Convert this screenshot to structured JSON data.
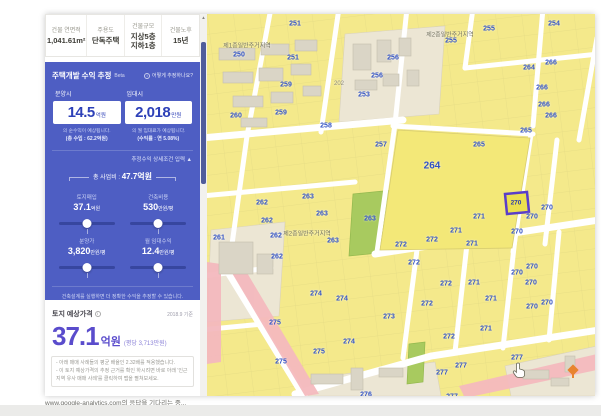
{
  "info_bar": {
    "columns": [
      {
        "label": "건물 연면적",
        "value": "1,041.61m²"
      },
      {
        "label": "주용도",
        "value": "단독주택"
      },
      {
        "label": "건물규모",
        "value": "지상5층\n지하1층"
      },
      {
        "label": "건물노후",
        "value": "15년"
      }
    ]
  },
  "profit_panel": {
    "title": "주택개발 수익 추정",
    "beta": "Beta",
    "how_link": "어떻게 추정하나요?",
    "sale_label": "분양시",
    "sale_value": "14.5",
    "sale_unit": "억원",
    "sale_caption": "의 순수익이 예상됩니다.",
    "sale_sub": "(총 수입 : 62.2억원)",
    "rent_label": "임대시",
    "rent_value": "2,018",
    "rent_unit": "만원",
    "rent_caption": "의 월 임대료가 예상됩니다.",
    "rent_sub": "(수익률 : 연 5.08%)",
    "detail_toggle": "추정수익 상세조건 입력",
    "total_label": "총 사업비 :",
    "total_value": "47.7억원",
    "sliders": [
      {
        "label": "토지매입",
        "value": "37.1",
        "unit": "억원"
      },
      {
        "label": "건축비용",
        "value": "530",
        "unit": "만원/평"
      },
      {
        "label": "분양가",
        "value": "3,820",
        "unit": "만원/평"
      },
      {
        "label": "월 임대수익",
        "value": "12.4",
        "unit": "만원/평"
      }
    ],
    "design_hint": "건축설계를 실행하면 더 정확한 수익을 추정할 수 있습니다.",
    "design_button": "인공지능 건축설계 실행"
  },
  "land_price": {
    "title": "토지 예상가격",
    "as_of": "2018.9 기준",
    "value": "37.1",
    "unit": "억원",
    "per_pyeong": "(평당 3,713만원)",
    "notes": [
      "- 아래 매매 사례들의 평균 배율인 2.32배를 적용했습니다.",
      "- 이 토지 예상가격의 추정 근거를 확인 하시려면 바로 아래 '인근 지역 유사 매매 사례'를 클릭하여 맵을 펼쳐보세요."
    ]
  },
  "status_bar": {
    "text": "www.google-analytics.com의 응답을 기다리는 중..."
  },
  "icons": {
    "info": "i",
    "help": "i",
    "up_arrow": "▲",
    "scroll_up": "▲"
  },
  "map": {
    "colors": {
      "parcel_yellow": "#f4e98b",
      "road_white": "#ffffff",
      "label_blue": "#3353c4",
      "green_parcel": "#a8ca5f",
      "pink_zone": "#f4b9be",
      "building_gray": "#dad5c6",
      "selected_outline": "#5a3ec9"
    },
    "selected_parcel": {
      "label": "270"
    },
    "zone_labels": [
      {
        "t": "제1종일반주거지역",
        "x": 40,
        "y": 31
      },
      {
        "t": "제2종일반주거지역",
        "x": 243,
        "y": 20
      },
      {
        "t": "제2종일반주거지역",
        "x": 100,
        "y": 219
      }
    ],
    "parcel_labels": [
      {
        "t": "250",
        "x": 32,
        "y": 41
      },
      {
        "t": "251",
        "x": 88,
        "y": 10
      },
      {
        "t": "251",
        "x": 86,
        "y": 44
      },
      {
        "t": "259",
        "x": 79,
        "y": 71
      },
      {
        "t": "259",
        "x": 74,
        "y": 99
      },
      {
        "t": "260",
        "x": 29,
        "y": 102
      },
      {
        "t": "261",
        "x": 12,
        "y": 224
      },
      {
        "t": "262",
        "x": 55,
        "y": 189
      },
      {
        "t": "262",
        "x": 60,
        "y": 207
      },
      {
        "t": "262",
        "x": 69,
        "y": 222
      },
      {
        "t": "262",
        "x": 70,
        "y": 243
      },
      {
        "t": "263",
        "x": 101,
        "y": 183
      },
      {
        "t": "263",
        "x": 115,
        "y": 200
      },
      {
        "t": "263",
        "x": 126,
        "y": 227
      },
      {
        "t": "263",
        "x": 163,
        "y": 205
      },
      {
        "t": "264",
        "x": 225,
        "y": 152,
        "big": true
      },
      {
        "t": "264",
        "x": 322,
        "y": 54
      },
      {
        "t": "265",
        "x": 272,
        "y": 131
      },
      {
        "t": "265",
        "x": 319,
        "y": 117
      },
      {
        "t": "266",
        "x": 344,
        "y": 49
      },
      {
        "t": "266",
        "x": 335,
        "y": 74
      },
      {
        "t": "266",
        "x": 337,
        "y": 91
      },
      {
        "t": "266",
        "x": 344,
        "y": 102
      },
      {
        "t": "253",
        "x": 157,
        "y": 81
      },
      {
        "t": "254",
        "x": 347,
        "y": 10
      },
      {
        "t": "255",
        "x": 282,
        "y": 15
      },
      {
        "t": "255",
        "x": 244,
        "y": 27
      },
      {
        "t": "256",
        "x": 186,
        "y": 44
      },
      {
        "t": "256",
        "x": 170,
        "y": 62
      },
      {
        "t": "257",
        "x": 174,
        "y": 131
      },
      {
        "t": "258",
        "x": 119,
        "y": 112
      },
      {
        "t": "202",
        "x": 132,
        "y": 70,
        "gray": true
      },
      {
        "t": "270",
        "x": 310,
        "y": 259
      },
      {
        "t": "270",
        "x": 324,
        "y": 269
      },
      {
        "t": "270",
        "x": 325,
        "y": 293
      },
      {
        "t": "270",
        "x": 340,
        "y": 289
      },
      {
        "t": "270",
        "x": 340,
        "y": 194
      },
      {
        "t": "270",
        "x": 325,
        "y": 203
      },
      {
        "t": "270",
        "x": 310,
        "y": 218
      },
      {
        "t": "270",
        "x": 325,
        "y": 253
      },
      {
        "t": "271",
        "x": 272,
        "y": 203
      },
      {
        "t": "271",
        "x": 249,
        "y": 217
      },
      {
        "t": "271",
        "x": 265,
        "y": 230
      },
      {
        "t": "271",
        "x": 267,
        "y": 269
      },
      {
        "t": "271",
        "x": 284,
        "y": 285
      },
      {
        "t": "271",
        "x": 279,
        "y": 315
      },
      {
        "t": "272",
        "x": 225,
        "y": 226
      },
      {
        "t": "272",
        "x": 194,
        "y": 231
      },
      {
        "t": "272",
        "x": 207,
        "y": 249
      },
      {
        "t": "272",
        "x": 239,
        "y": 270
      },
      {
        "t": "272",
        "x": 220,
        "y": 290
      },
      {
        "t": "272",
        "x": 242,
        "y": 323
      },
      {
        "t": "273",
        "x": 182,
        "y": 303
      },
      {
        "t": "274",
        "x": 109,
        "y": 280
      },
      {
        "t": "274",
        "x": 135,
        "y": 285
      },
      {
        "t": "274",
        "x": 142,
        "y": 328
      },
      {
        "t": "275",
        "x": 68,
        "y": 309
      },
      {
        "t": "275",
        "x": 112,
        "y": 338
      },
      {
        "t": "275",
        "x": 74,
        "y": 348
      },
      {
        "t": "276",
        "x": 159,
        "y": 381
      },
      {
        "t": "277",
        "x": 310,
        "y": 344
      },
      {
        "t": "277",
        "x": 254,
        "y": 352
      },
      {
        "t": "277",
        "x": 235,
        "y": 359
      },
      {
        "t": "277",
        "x": 245,
        "y": 383
      }
    ]
  }
}
